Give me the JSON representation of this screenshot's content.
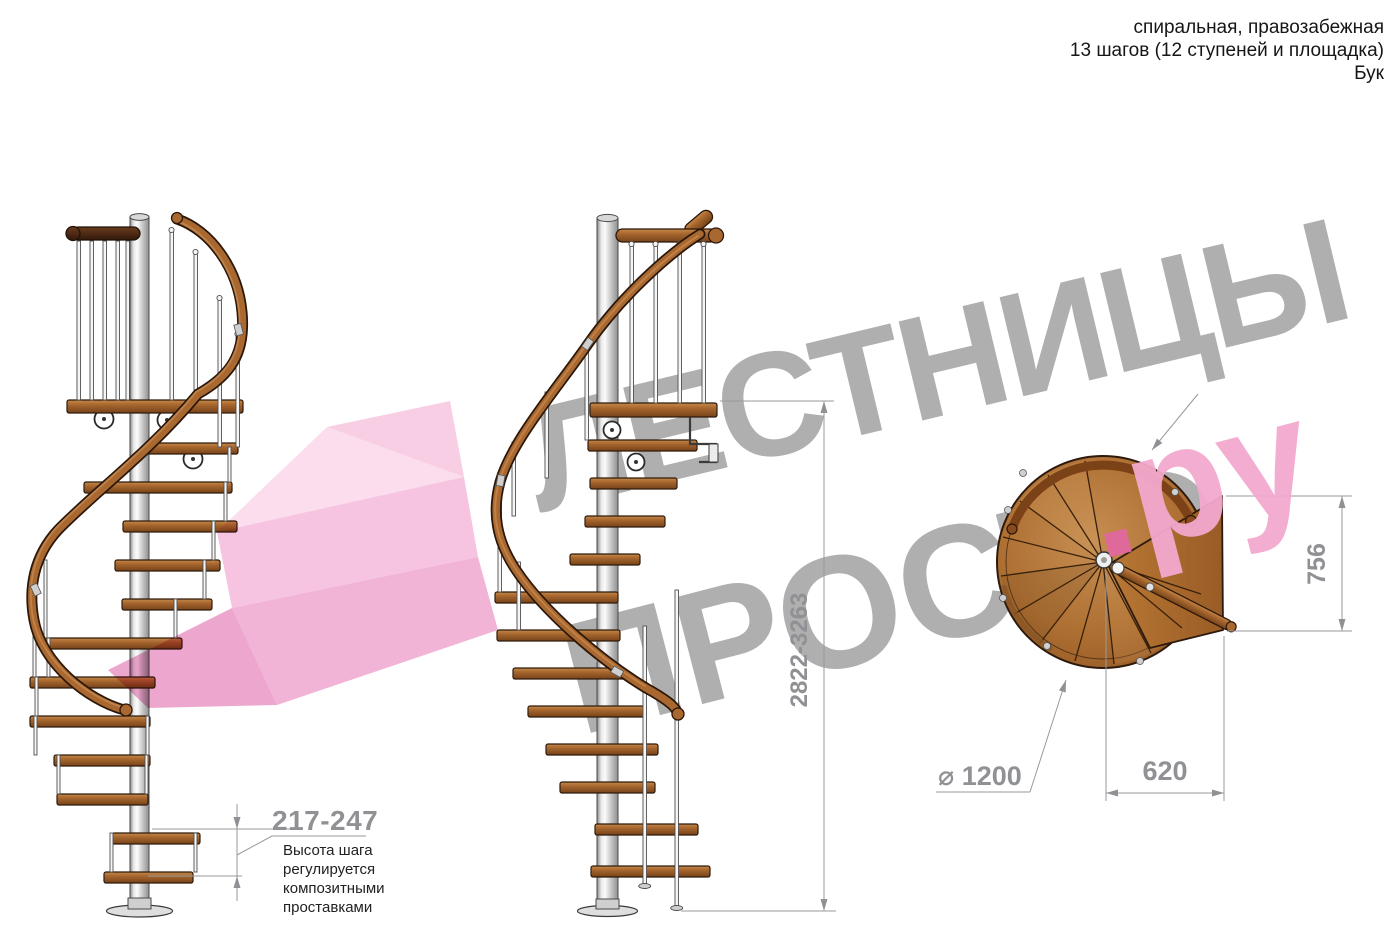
{
  "header": {
    "lines": [
      "спиральная, правозабежная",
      "13 шагов (12 ступеней и площадка)",
      "Бук"
    ]
  },
  "watermark": {
    "word1": "ЛЕСТНИЦЫ",
    "word2": "ПРОСТО",
    "suffix_dot": ".",
    "suffix_letters": "ру"
  },
  "dimensions": {
    "overall_height": "2822-3263",
    "platform_depth": "756",
    "passage_width": "620",
    "diameter": "⌀ 1200",
    "step_height": "217-247"
  },
  "note": {
    "lines": [
      "Высота шага",
      "регулируется",
      "композитными",
      "проставками"
    ]
  },
  "colors": {
    "wood": "#a9682f",
    "wood_dark": "#7a4418",
    "wood_outline": "#2e1a0c",
    "metal": "#d9d9d9",
    "dimension_gray": "#8f9194",
    "text_dark": "#161616",
    "watermark_gray": "#9e9e9e",
    "watermark_pink": "#f2a9ce",
    "arrow_pink": "#eea6cf"
  }
}
